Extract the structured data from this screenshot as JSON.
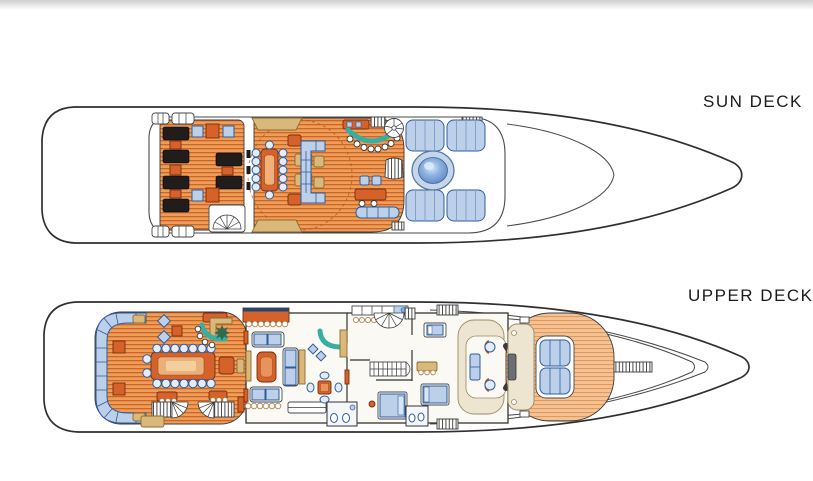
{
  "page": {
    "title": "Yacht deck plans",
    "background": "#ffffff",
    "top_strip_color": "#cfcfcf"
  },
  "palette": {
    "outline": "#2f2f2f",
    "navy": "#2e5d9e",
    "teak": "#f09d58",
    "teak_stripe": "#c9662a",
    "teak_light": "#f6c294",
    "teak_light_stripe": "#dd9a5e",
    "upholstery_blue": "#bcd0ea",
    "orange": "#d4622a",
    "tan": "#d9b87a",
    "teal": "#38afa0",
    "cream": "#ede5d0",
    "lounger_black": "#201d1c",
    "pool_water": "#5c88c4"
  },
  "decks": [
    {
      "id": "sun-deck",
      "label": "SUN DECK",
      "features": [
        "sun-loungers",
        "side-tables",
        "alfresco-dining-table",
        "dining-chairs",
        "sun-pad-wedges",
        "lounge-sofa",
        "cocktail-tables",
        "wet-bar",
        "bar-stools",
        "dumbwaiter",
        "spiral-staircase",
        "funnel-mast",
        "sideboard",
        "bench-seat",
        "jacuzzi",
        "jacuzzi-sun-pads",
        "aft-stairs",
        "boarding-ladders",
        "davit-lockers"
      ]
    },
    {
      "id": "upper-deck",
      "label": "UPPER DECK",
      "features": [
        "wraparound-aft-sofa",
        "corner-tables",
        "alfresco-dining-table",
        "dining-chairs",
        "host-armchair",
        "aft-bar",
        "palm-planter",
        "planter-boxes",
        "twin-stairs-to-main-deck",
        "skylounge-sofas",
        "coffee-table",
        "media-cabinet",
        "game-table",
        "skylounge-bar",
        "pantry-counters",
        "fan-staircase",
        "mid-staircase",
        "day-heads",
        "guest-beds",
        "wheelhouse-console",
        "pilot-chairs",
        "observation-settee",
        "chart-table",
        "bow-sun-pads",
        "bow-platform",
        "bowsprit-walkway",
        "side-boarding-gates"
      ]
    }
  ]
}
